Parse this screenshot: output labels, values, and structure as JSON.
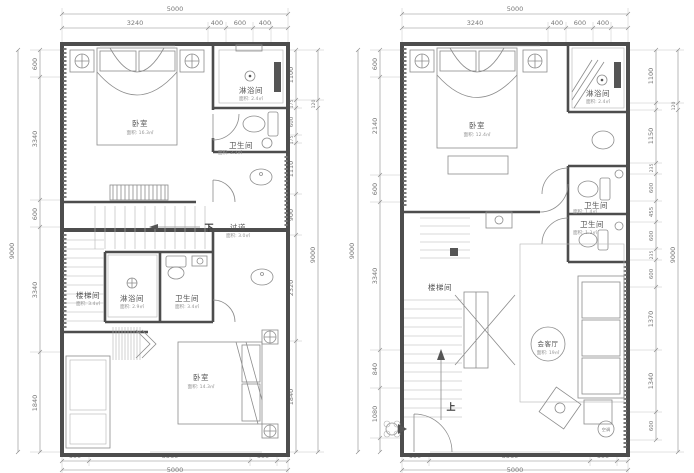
{
  "colors": {
    "background": "#ffffff",
    "wall": "#4d4d4d",
    "line": "#8c8c8c",
    "dim_text": "#787878",
    "room_text": "#555555"
  },
  "plans": [
    {
      "id": "left-floor-plan",
      "top_total": "5000",
      "top_segments": [
        "3240",
        "400",
        "600",
        "400"
      ],
      "side_total": "9000",
      "left_segments": [
        "600",
        "3340",
        "600",
        "3340",
        "1840"
      ],
      "right_segments": [
        "1100",
        "175",
        "600",
        "175",
        "1110",
        "900",
        "2320",
        "1840"
      ],
      "right_outer_segments": [
        "120",
        "9000"
      ],
      "bottom_segments": [
        "600",
        "3560",
        "600"
      ],
      "bottom_total": "5000",
      "stair_direction": "下",
      "rooms": [
        {
          "label": "卧室",
          "area": "面积: 16.3㎡"
        },
        {
          "label": "淋浴间",
          "area": "面积: 2.4㎡"
        },
        {
          "label": "卫生间",
          "area": "面积: 2.2㎡"
        },
        {
          "label": "过道",
          "area": "面积: 3.0㎡"
        },
        {
          "label": "楼梯间",
          "area": "面积: 3.4㎡"
        },
        {
          "label": "淋浴间",
          "area": "面积: 2.9㎡"
        },
        {
          "label": "卫生间",
          "area": "面积: 3.4㎡"
        },
        {
          "label": "卧室",
          "area": "面积: 14.3㎡"
        }
      ]
    },
    {
      "id": "right-floor-plan",
      "top_total": "5000",
      "top_segments": [
        "3240",
        "400",
        "600",
        "400"
      ],
      "side_total": "9000",
      "left_segments": [
        "600",
        "2140",
        "600",
        "3340",
        "840",
        "1080"
      ],
      "right_segments": [
        "1100",
        "1150",
        "235",
        "600",
        "455",
        "600",
        "235",
        "600",
        "1370",
        "1340",
        "600"
      ],
      "right_outer_segments": [
        "120",
        "9000"
      ],
      "bottom_segments": [
        "600",
        "3560",
        "600"
      ],
      "bottom_total": "5000",
      "stair_direction": "上",
      "rooms": [
        {
          "label": "卧室",
          "area": "面积: 12.4㎡"
        },
        {
          "label": "淋浴间",
          "area": "面积: 2.4㎡"
        },
        {
          "label": "卫生间",
          "area": "面积: 1.4㎡"
        },
        {
          "label": "卫生间",
          "area": "面积: 1.3㎡"
        },
        {
          "label": "楼梯间",
          "area": ""
        },
        {
          "label": "会客厅",
          "area": "面积: 19㎡"
        },
        {
          "label": "空调",
          "area": ""
        }
      ]
    }
  ]
}
